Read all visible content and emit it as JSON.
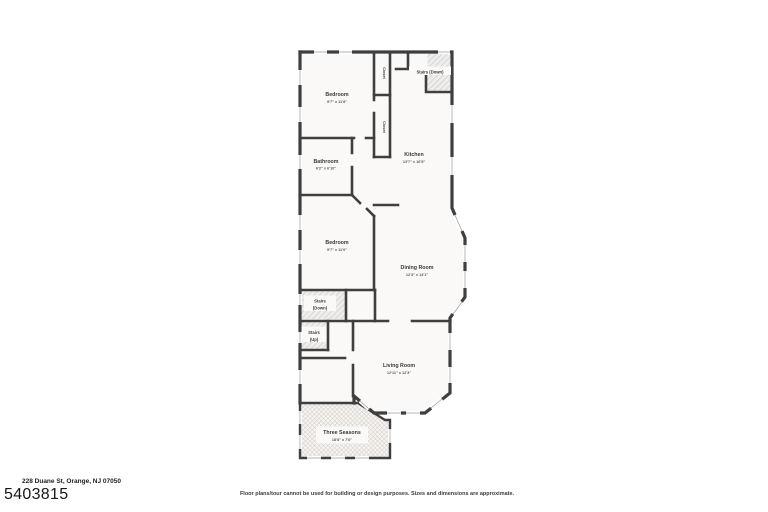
{
  "floorplan": {
    "rooms": [
      {
        "id": "bedroom-1",
        "name": "Bedroom",
        "dims": "9'7\" x 11'8\""
      },
      {
        "id": "kitchen",
        "name": "Kitchen",
        "dims": "13'7\" x 16'5\""
      },
      {
        "id": "bathroom",
        "name": "Bathroom",
        "dims": "6'2\" x 6'10\""
      },
      {
        "id": "bedroom-2",
        "name": "Bedroom",
        "dims": "9'7\" x 11'0\""
      },
      {
        "id": "dining-room",
        "name": "Dining Room",
        "dims": "12'3\" x 14'1\""
      },
      {
        "id": "living-room",
        "name": "Living Room",
        "dims": "12'11\" x 12'3\""
      },
      {
        "id": "three-seasons",
        "name": "Three Seasons",
        "dims": "18'8\" x 7'6\""
      }
    ],
    "features": {
      "stairs_down_upper": "Stairs (Down)",
      "stairs_down_mid": {
        "line1": "Stairs",
        "line2": "(Down)"
      },
      "stairs_up": {
        "line1": "Stairs",
        "line2": "(Up)"
      },
      "closet_upper": "Closet",
      "closet_lower": "Closet"
    },
    "colors": {
      "wall": "#3f3f3f",
      "label": "#3a3a3a",
      "window": "#9a9a9a",
      "room_fill": "#faf9f8",
      "hatch": "#c9c5c1"
    }
  },
  "footer": {
    "address": "228 Duane St, Orange, NJ 07050",
    "listing_number": "5403815",
    "disclaimer": "Floor plans/tour cannot be used for building or design purposes. Sizes and dimensions are approximate."
  }
}
